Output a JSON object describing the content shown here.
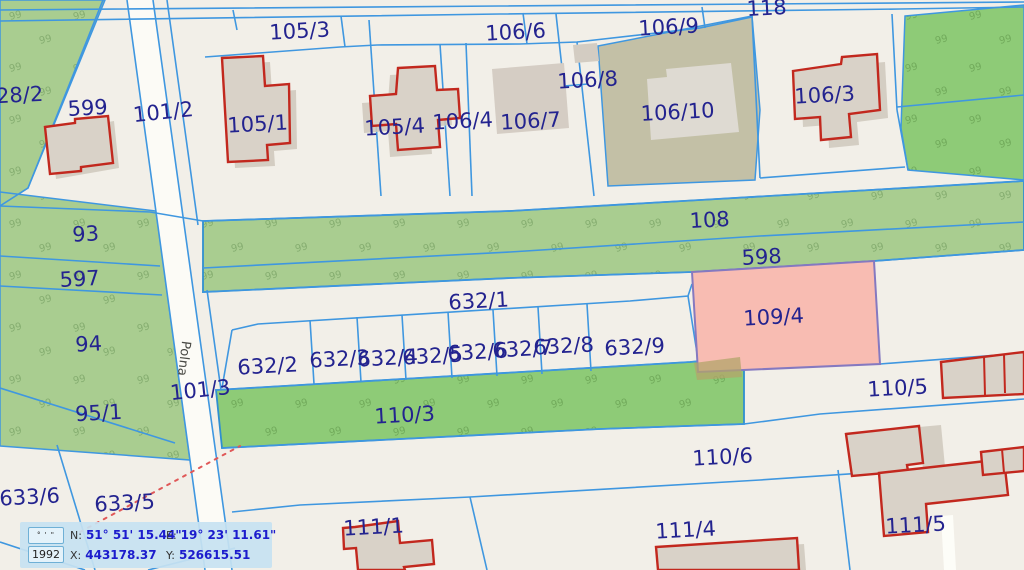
{
  "map": {
    "selected_parcel": {
      "id": "109/4",
      "fill": "#f8bcb2",
      "stroke": "#8579c0"
    },
    "street": {
      "name": "Polna"
    },
    "veg_glyph": "99",
    "colors": {
      "background": "#f2efe8",
      "parcel_line": "#3f97e0",
      "label": "#23238f",
      "street_label": "#4a4a45",
      "green_muted": "#a9cd90",
      "green_bright": "#8ecb77",
      "olive": "#c3c0a6",
      "road_fill": "#fcfbf6",
      "building_fill": "#d9d2c8",
      "building_outline": "#c2281e",
      "dotted_line": "#e05858"
    },
    "parcel_labels": [
      {
        "t": "28/2",
        "x": 20,
        "y": 102
      },
      {
        "t": "599",
        "x": 88,
        "y": 115
      },
      {
        "t": "101/2",
        "x": 164,
        "y": 119,
        "r": -6
      },
      {
        "t": "105/1",
        "x": 258,
        "y": 131
      },
      {
        "t": "105/3",
        "x": 300,
        "y": 38
      },
      {
        "t": "105/4",
        "x": 395,
        "y": 134
      },
      {
        "t": "106/4",
        "x": 463,
        "y": 128
      },
      {
        "t": "106/6",
        "x": 516,
        "y": 39
      },
      {
        "t": "106/7",
        "x": 531,
        "y": 128
      },
      {
        "t": "106/8",
        "x": 588,
        "y": 87
      },
      {
        "t": "106/9",
        "x": 669,
        "y": 34
      },
      {
        "t": "106/10",
        "x": 678,
        "y": 119
      },
      {
        "t": "106/3",
        "x": 825,
        "y": 102
      },
      {
        "t": "118",
        "x": 767,
        "y": 15
      },
      {
        "t": "93",
        "x": 86,
        "y": 241
      },
      {
        "t": "108",
        "x": 710,
        "y": 227
      },
      {
        "t": "597",
        "x": 80,
        "y": 286
      },
      {
        "t": "598",
        "x": 762,
        "y": 264
      },
      {
        "t": "632/1",
        "x": 479,
        "y": 308
      },
      {
        "t": "94",
        "x": 89,
        "y": 351
      },
      {
        "t": "632/2",
        "x": 268,
        "y": 373
      },
      {
        "t": "632/3",
        "x": 340,
        "y": 366
      },
      {
        "t": "632/4",
        "x": 388,
        "y": 365
      },
      {
        "t": "632/5",
        "x": 433,
        "y": 363
      },
      {
        "t": "632/6",
        "x": 478,
        "y": 359
      },
      {
        "t": "632/7",
        "x": 523,
        "y": 356
      },
      {
        "t": "632/8",
        "x": 564,
        "y": 353
      },
      {
        "t": "632/9",
        "x": 635,
        "y": 354
      },
      {
        "t": "109/4",
        "x": 774,
        "y": 324
      },
      {
        "t": "101/3",
        "x": 201,
        "y": 397,
        "r": -6
      },
      {
        "t": "110/5",
        "x": 898,
        "y": 395
      },
      {
        "t": "95/1",
        "x": 99,
        "y": 420
      },
      {
        "t": "110/3",
        "x": 405,
        "y": 422
      },
      {
        "t": "110/6",
        "x": 723,
        "y": 464
      },
      {
        "t": "633/6",
        "x": 30,
        "y": 504
      },
      {
        "t": "633/5",
        "x": 125,
        "y": 510
      },
      {
        "t": "111/1",
        "x": 374,
        "y": 534
      },
      {
        "t": "111/4",
        "x": 686,
        "y": 537
      },
      {
        "t": "111/5",
        "x": 916,
        "y": 532
      },
      {
        "t": "Polna",
        "x": 180,
        "y": 358,
        "r": 97,
        "size": 13,
        "color": "#4a4a45",
        "name": "street-label-polna"
      }
    ]
  },
  "statusbar": {
    "dms_button": "° ' \"",
    "crs_button": "1992",
    "n_label": "N:",
    "n_value": "51° 51' 15.44\"",
    "e_label": "E:",
    "e_value": "19° 23' 11.61\"",
    "x_label": "X:",
    "x_value": "443178.37",
    "y_label": "Y:",
    "y_value": "526615.51"
  }
}
